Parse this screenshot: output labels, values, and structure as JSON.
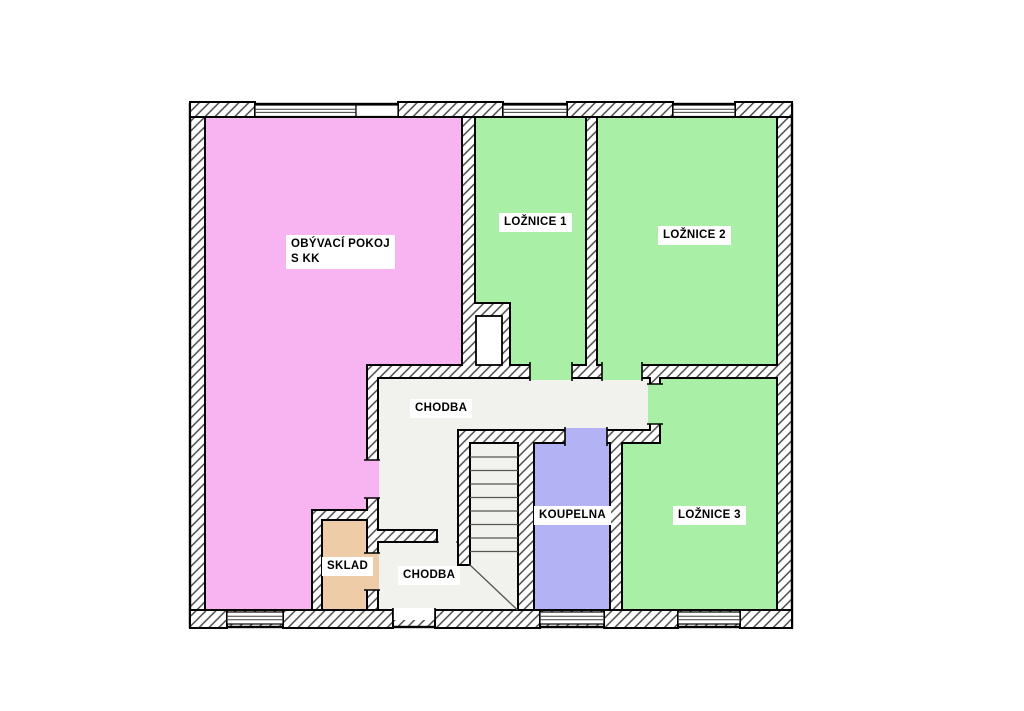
{
  "page": {
    "background": "#ffffff"
  },
  "floorplan": {
    "type": "floor-plan",
    "outline_color": "#000000",
    "wall_hatch_color": "#3f3f3f",
    "rooms": {
      "obyvaci_pokoj": {
        "label_line1": "OBÝVACÍ POKOJ",
        "label_line2": "S KK",
        "color": "#f8b3f1"
      },
      "loznice_1": {
        "label": "LOŽNICE 1",
        "color": "#a9f0a6"
      },
      "loznice_2": {
        "label": "LOŽNICE 2",
        "color": "#a9f0a6"
      },
      "loznice_3": {
        "label": "LOŽNICE 3",
        "color": "#a9f0a6"
      },
      "chodba_upper": {
        "label": "CHODBA",
        "color": "#f1f1ee"
      },
      "chodba_lower": {
        "label": "CHODBA",
        "color": "#f1f1ee"
      },
      "koupelna": {
        "label": "KOUPELNA",
        "color": "#b2b2f5"
      },
      "sklad": {
        "label": "SKLAD",
        "color": "#eecca8"
      },
      "shaft": {
        "color": "#ffffff"
      }
    }
  }
}
